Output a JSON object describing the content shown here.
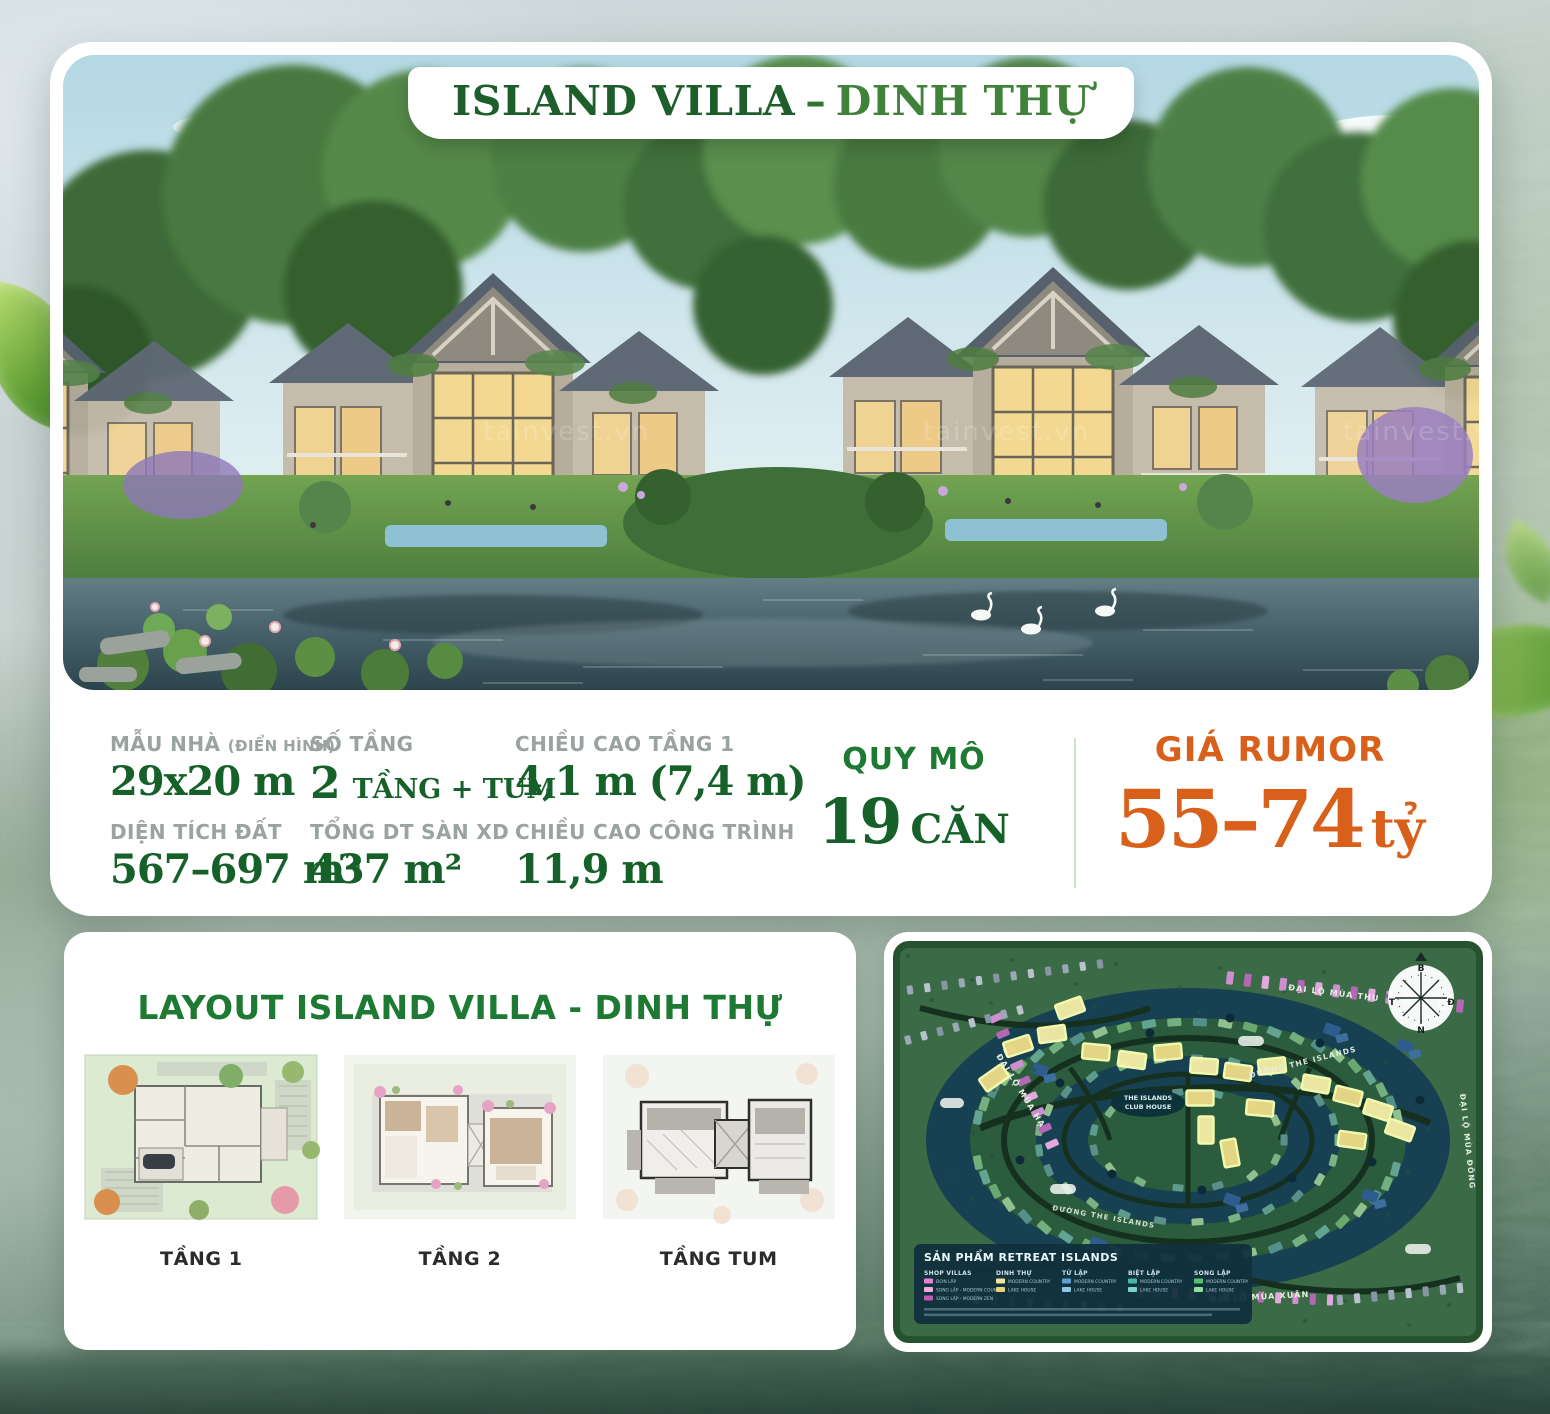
{
  "colors": {
    "green": "#166029",
    "green_bright": "#1e7a33",
    "orange": "#d8601a",
    "label_gray": "#9aa39e",
    "map_highlight": "#ead988"
  },
  "hero": {
    "title_primary": "ISLAND VILLA",
    "title_separator": "–",
    "title_secondary": "DINH THỰ",
    "watermark": "tainvest.vn"
  },
  "specs": {
    "columns": [
      {
        "top_label": "MẪU NHÀ",
        "top_note": "(ĐIỂN HÌNH)",
        "top_value": "29x20 m",
        "bottom_label": "DIỆN TÍCH ĐẤT",
        "bottom_value": "567–697 m²"
      },
      {
        "top_label": "SỐ TẦNG",
        "top_value_big": "2",
        "top_value_small": "TẦNG + TUM",
        "bottom_label": "TỔNG DT SÀN XD",
        "bottom_value": "437 m²"
      },
      {
        "top_label": "CHIỀU CAO TẦNG 1",
        "top_value": "4,1 m (7,4 m)",
        "bottom_label": "CHIỀU CAO CÔNG TRÌNH",
        "bottom_value": "11,9 m"
      }
    ],
    "scale": {
      "label": "QUY MÔ",
      "number": "19",
      "unit": "CĂN"
    },
    "price": {
      "label": "GIÁ RUMOR",
      "number": "55–74",
      "unit": "tỷ"
    }
  },
  "layout": {
    "title": "LAYOUT ISLAND VILLA - DINH THỰ",
    "plans": [
      {
        "label": "TẦNG 1"
      },
      {
        "label": "TẦNG 2"
      },
      {
        "label": "TẦNG TUM"
      }
    ]
  },
  "map": {
    "roads": {
      "top": "ĐẠI LỘ MÙA THU",
      "left": "ĐẠI LỘ MÙA HẠ",
      "bottom": "ĐẠI LỘ MÙA XUÂN",
      "right": "ĐẠI LỘ MÙA ĐÔNG",
      "inner": "ĐƯỜNG THE ISLANDS",
      "inner2": "ĐƯỜNG THE ISLANDS"
    },
    "club_house_line1": "THE ISLANDS",
    "club_house_line2": "CLUB HOUSE",
    "compass": {
      "n": "B",
      "e": "Đ",
      "s": "N",
      "w": "T"
    },
    "legend": {
      "title": "SẢN PHẨM RETREAT ISLANDS",
      "columns": [
        {
          "header": "SHOP VILLAS",
          "items": [
            {
              "color": "#e77fd2",
              "label": "ĐƠN LẬP"
            },
            {
              "color": "#f0a9e2",
              "label": "SONG LẬP - MODERN COUNTRY"
            },
            {
              "color": "#c05ab2",
              "label": "SONG LẬP - MODERN ZEN"
            }
          ]
        },
        {
          "header": "DINH THỰ",
          "items": [
            {
              "color": "#f3e6a2",
              "label": "MODERN COUNTRY"
            },
            {
              "color": "#e8d27c",
              "label": "LAKE HOUSE"
            }
          ]
        },
        {
          "header": "TỨ LẬP",
          "items": [
            {
              "color": "#5b9fd4",
              "label": "MODERN COUNTRY"
            },
            {
              "color": "#8fc3e8",
              "label": "LAKE HOUSE"
            }
          ]
        },
        {
          "header": "BIỆT LẬP",
          "items": [
            {
              "color": "#49b8a8",
              "label": "MODERN COUNTRY"
            },
            {
              "color": "#7fd4c8",
              "label": "LAKE HOUSE"
            }
          ]
        },
        {
          "header": "SONG LẬP",
          "items": [
            {
              "color": "#58c46a",
              "label": "MODERN COUNTRY"
            },
            {
              "color": "#8fdd9a",
              "label": "LAKE HOUSE"
            }
          ]
        }
      ]
    }
  }
}
